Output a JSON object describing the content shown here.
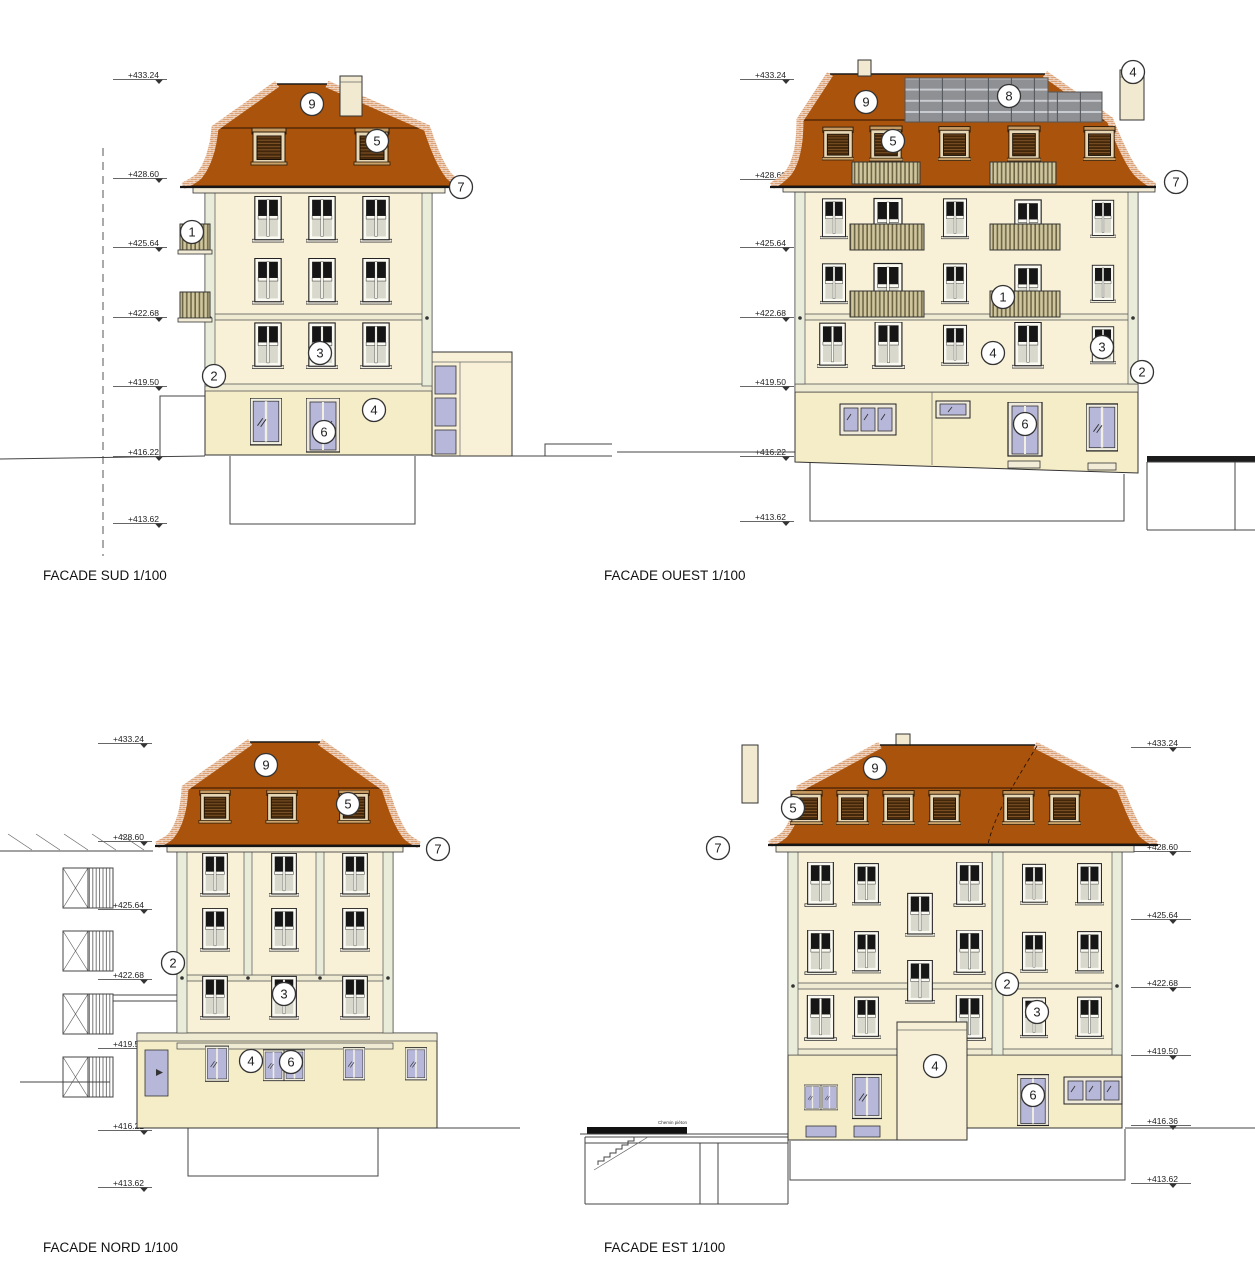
{
  "page": {
    "background": "#ffffff"
  },
  "colors": {
    "roof": "#a9530d",
    "roof_edge_brick": "#dca277",
    "wall": "#f8f1d8",
    "wall_ground": "#f5ecc8",
    "trim": "#e9ecd9",
    "dormer_louvre": "#42270a",
    "balcony_slats": "#cfc69e",
    "glazing_lavender": "#b7b7da",
    "window_sash_dark": "#161616",
    "solar_panel": "#8e9094",
    "line": "#333333"
  },
  "facades": {
    "sud": {
      "title": "FACADE SUD 1/100",
      "elev": {
        "v433": "+433.24",
        "v428": "+428.60",
        "v425": "+425.64",
        "v422": "+422.68",
        "v419": "+419.50",
        "v416": "+416.22",
        "v413": "+413.62"
      },
      "call": {
        "n1": "1",
        "n2": "2",
        "n3": "3",
        "n4": "4",
        "n5": "5",
        "n6": "6",
        "n7": "7",
        "n9": "9"
      }
    },
    "ouest": {
      "title": "FACADE OUEST 1/100",
      "elev": {
        "v433": "+433.24",
        "v428": "+428.60",
        "v425": "+425.64",
        "v422": "+422.68",
        "v419": "+419.50",
        "v416": "+416.22",
        "v413": "+413.62"
      },
      "call": {
        "n1": "1",
        "n2": "2",
        "n3": "3",
        "n4": "4",
        "n4b": "4",
        "n5": "5",
        "n6": "6",
        "n7": "7",
        "n8": "8",
        "n9": "9"
      }
    },
    "nord": {
      "title": "FACADE NORD 1/100",
      "elev": {
        "v433": "+433.24",
        "v428": "+428.60",
        "v425": "+425.64",
        "v422": "+422.68",
        "v419": "+419.50",
        "v416": "+416.22",
        "v413": "+413.62"
      },
      "call": {
        "n2": "2",
        "n3": "3",
        "n4": "4",
        "n5": "5",
        "n6": "6",
        "n7": "7",
        "n9": "9"
      }
    },
    "est": {
      "title": "FACADE EST 1/100",
      "elev": {
        "v433": "+433.24",
        "v428": "+428.60",
        "v425": "+425.64",
        "v422": "+422.68",
        "v419": "+419.50",
        "v416": "+416.36",
        "v413": "+413.62"
      },
      "call": {
        "n2": "2",
        "n3": "3",
        "n4": "4",
        "n5": "5",
        "n6": "6",
        "n7": "7",
        "n9": "9"
      },
      "site_label": "Chemin piéton"
    }
  }
}
